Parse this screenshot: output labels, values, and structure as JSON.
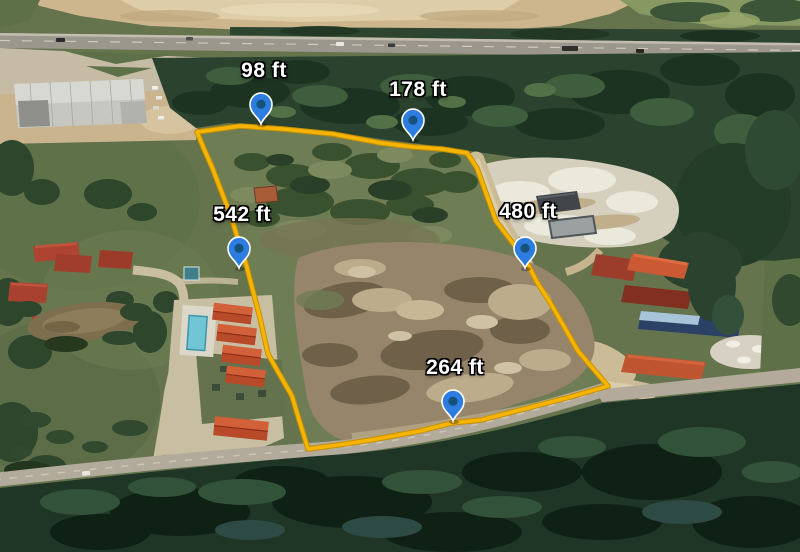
{
  "measurements": [
    {
      "id": "north-west-segment",
      "value": "98 ft"
    },
    {
      "id": "north-segment",
      "value": "178 ft"
    },
    {
      "id": "west-segment",
      "value": "542 ft"
    },
    {
      "id": "east-segment",
      "value": "480 ft"
    },
    {
      "id": "south-segment",
      "value": "264 ft"
    }
  ],
  "colors": {
    "boundary": "#F4B400",
    "boundary_edge": "#C78F00",
    "pin_fill": "#2D7DE1",
    "pin_dot": "#14527C",
    "pin_stroke": "#FFFFFF",
    "label_text": "#FFFFFF"
  }
}
